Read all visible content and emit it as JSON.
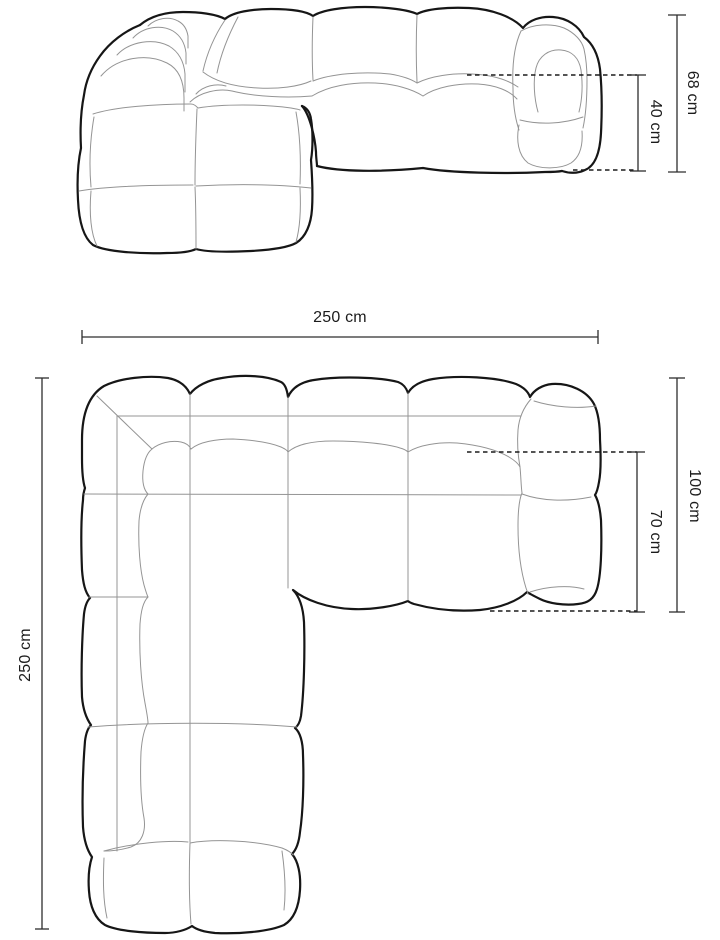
{
  "front_view": {
    "dimensions": {
      "total_height": "68 cm",
      "seat_height": "40 cm"
    }
  },
  "plan_view": {
    "dimensions": {
      "width": "250 cm",
      "depth": "250 cm",
      "right_section_depth": "100 cm",
      "seat_depth": "70 cm"
    }
  },
  "style": {
    "background": "#ffffff",
    "outline_color": "#161616",
    "seam_color": "#949494",
    "dimension_color": "#2e2e2e",
    "text_color": "#1c1c1c"
  }
}
